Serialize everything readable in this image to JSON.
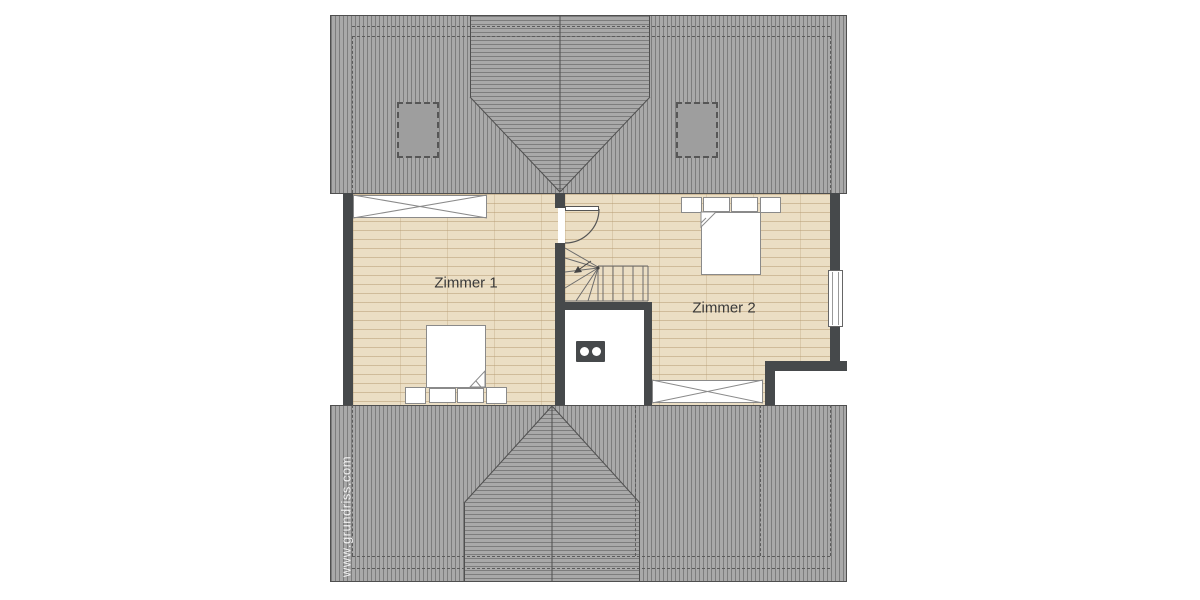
{
  "rooms": [
    {
      "label": "Zimmer 1"
    },
    {
      "label": "Zimmer 2"
    }
  ],
  "watermark": {
    "text": "www.grundriss.com"
  },
  "colors": {
    "background": "#ffffff",
    "roof_fill": "#a9a9a9",
    "roof_hatch_line": "#7d7d7d",
    "roof_outline": "#4f4f4f",
    "dashed_outline": "#5c5c5c",
    "skylight_fill": "#9e9e9e",
    "wall": "#46494b",
    "floor_base": "#ebdec4",
    "floor_plank_line": "#b49970",
    "furniture_fill": "#ffffff",
    "furniture_outline": "#8a8a8a",
    "detail_line": "#5a5a5a",
    "label_text": "#3a3a3a",
    "watermark_text": "#ffffff"
  },
  "symbols": {
    "roof": "hatched-hip-roof-with-cross-gable",
    "skylights": "dashed-roof-window",
    "beds": "double-bed-top-view-with-folded-duvet",
    "wardrobes": "crossed-rectangle-wardrobe",
    "stairs": "winder-staircase-with-direction-arrow",
    "door": "door-with-quarter-circle-swing",
    "chimney": "chimney-block-with-two-flues",
    "window": "double-line-wall-window"
  }
}
